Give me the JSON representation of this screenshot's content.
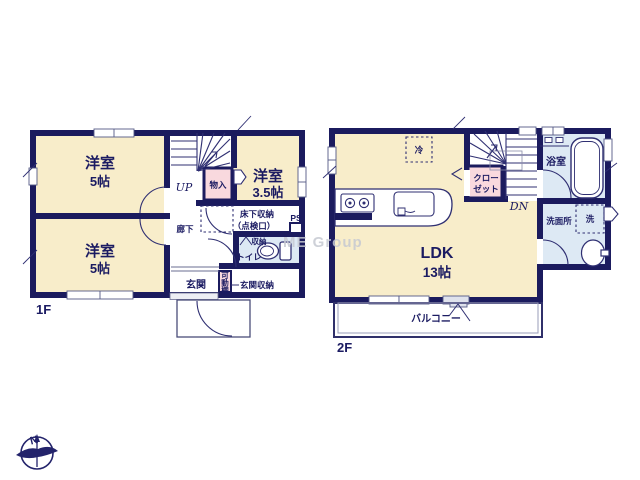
{
  "watermark": "ME Group",
  "compass": {
    "north_label": "N"
  },
  "palette": {
    "wall": "#1b1b5e",
    "thin_line": "#2f2f72",
    "room_fill": "#f8edca",
    "closet_pink": "#f9d9de",
    "wet_area_blue": "#dde9f4",
    "label_navy": "#1b1b62",
    "watermark_gray": "#c6c9d2"
  },
  "floor1": {
    "label": "1F",
    "bedroom_top": {
      "name": "洋室",
      "size": "5帖"
    },
    "bedroom_bottom": {
      "name": "洋室",
      "size": "5帖"
    },
    "bedroom_right": {
      "name": "洋室",
      "size": "3.5帖"
    },
    "stair_direction": "UP",
    "closet": "物入",
    "underfloor_storage": "床下収納",
    "underfloor_storage_note": "（点検口）",
    "pipe_space": "PS",
    "hallway": "廊下",
    "toilet_shelf": "収納",
    "toilet": "トイレ",
    "entrance": "玄関",
    "movable_shelf_chars": [
      "可",
      "動",
      "棚"
    ],
    "entrance_storage": "玄関収納"
  },
  "floor2": {
    "label": "2F",
    "ldk": {
      "name": "LDK",
      "size": "13帖"
    },
    "refrigerator": "冷",
    "closet_line1": "クロー",
    "closet_line2": "ゼット",
    "stair_direction": "DN",
    "bathroom": "浴室",
    "washroom": "洗面所",
    "washer": "洗",
    "balcony": "バルコニー"
  }
}
